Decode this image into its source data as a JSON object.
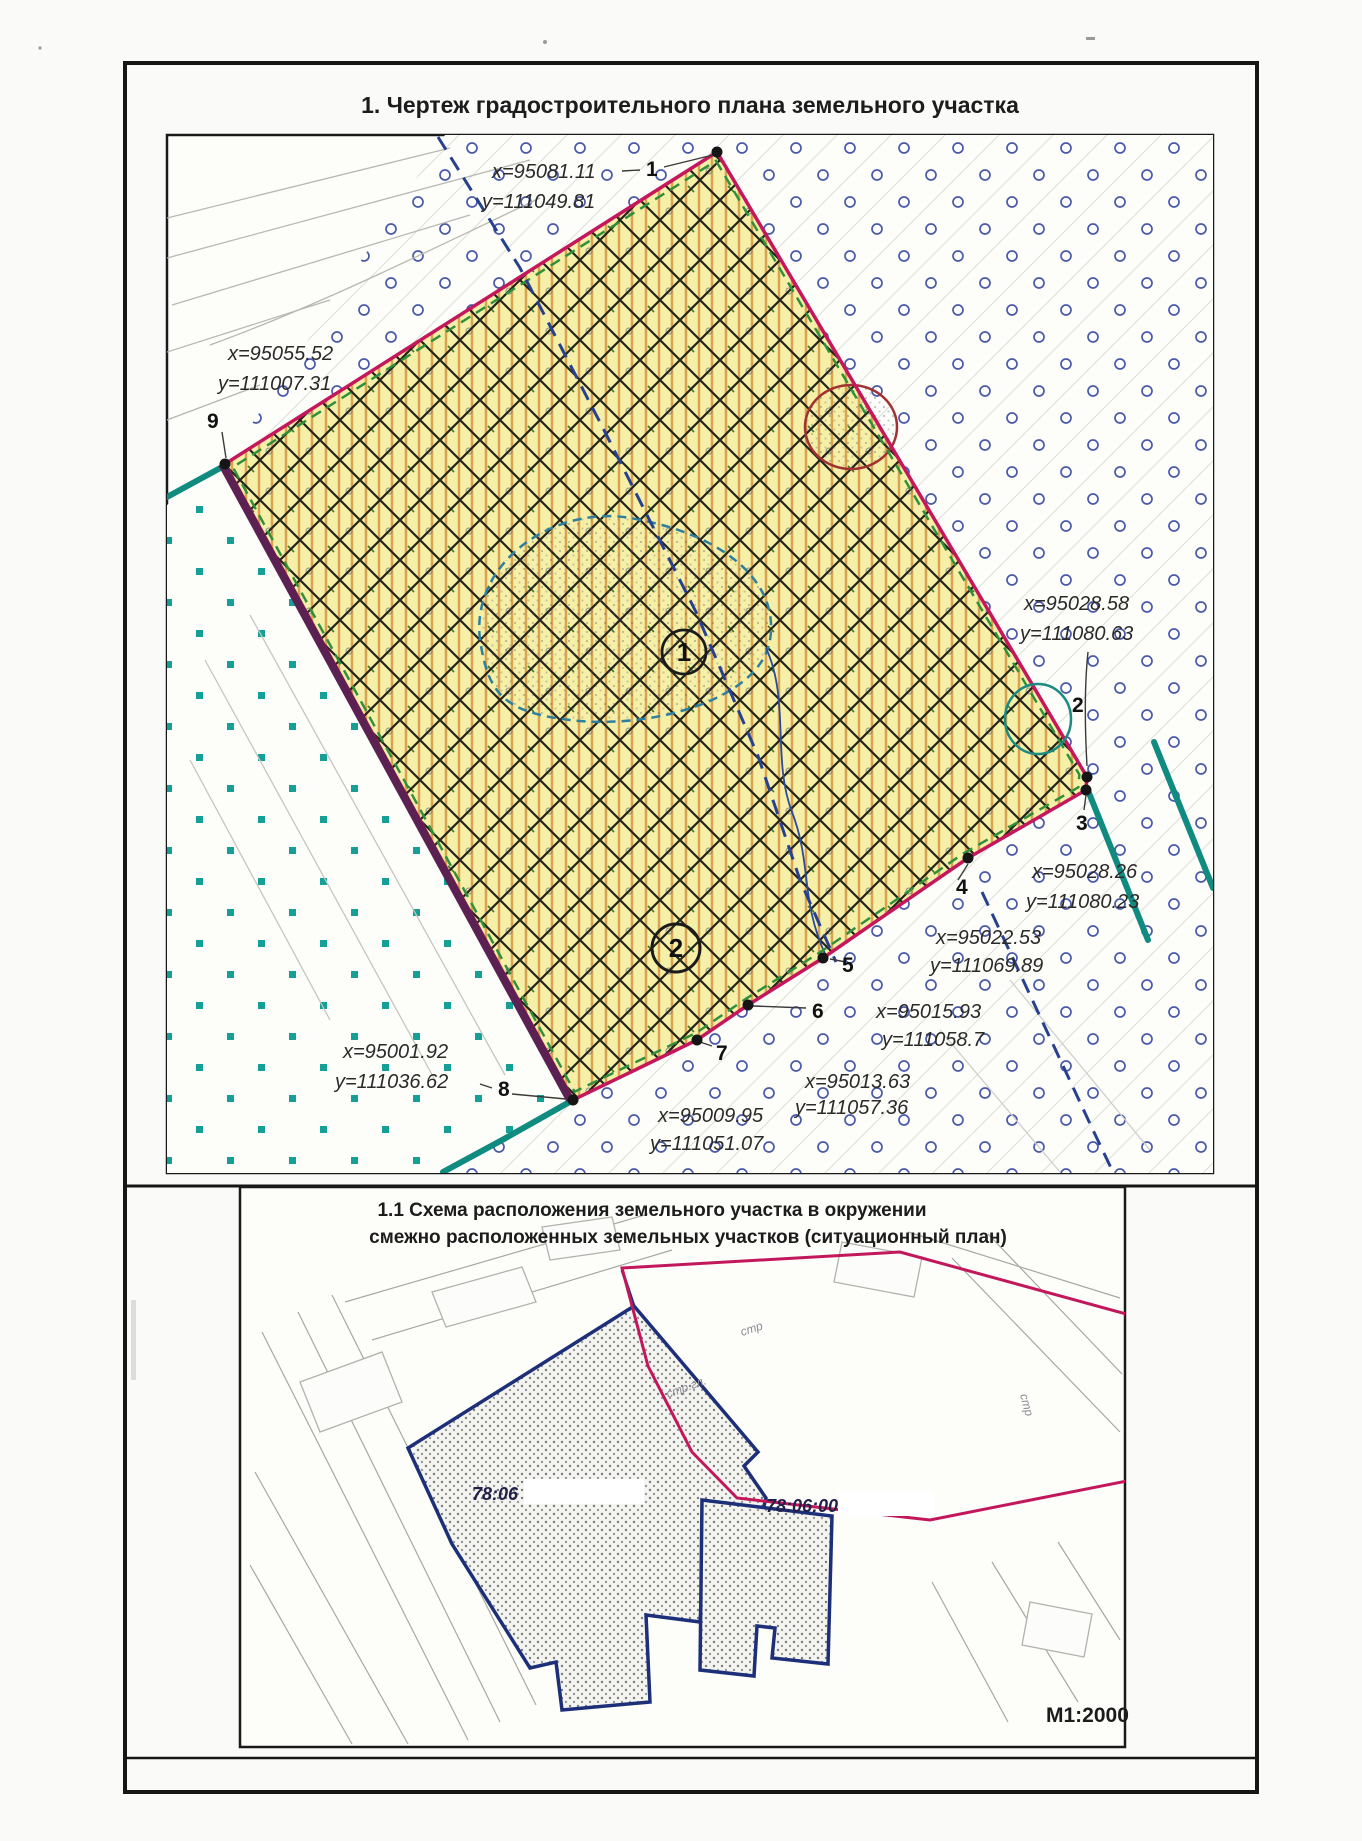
{
  "doc": {
    "main_title": "1. Чертеж градостроительного плана земельного участка",
    "situational_title_line1": "1.1 Схема расположения земельного участка  в окружении",
    "situational_title_line2": "смежно расположенных земельных участков (ситуационный план)",
    "scale_label": "М1:2000"
  },
  "main_plan": {
    "zone_labels": [
      {
        "id": "1"
      },
      {
        "id": "2"
      }
    ],
    "points": [
      {
        "n": "1",
        "x": "x=95081.11",
        "y": "y=111049.81"
      },
      {
        "n": "2",
        "x": "x=95028.58",
        "y": "y=111080.63"
      },
      {
        "n": "3",
        "x": "x=95028.26",
        "y": "y=111080.23"
      },
      {
        "n": "4",
        "x": "x=95022.53",
        "y": "y=111069.89"
      },
      {
        "n": "5",
        "x": "x=95015.93",
        "y": "y=111058.7"
      },
      {
        "n": "6",
        "x": "x=95013.63",
        "y": "y=111057.36"
      },
      {
        "n": "7",
        "x": "x=95009.95",
        "y": "y=111051.07"
      },
      {
        "n": "8",
        "x": "x=95001.92",
        "y": "y=111036.62"
      },
      {
        "n": "9",
        "x": "x=95055.52",
        "y": "y=111007.31"
      }
    ]
  },
  "situational_plan": {
    "cadastral_label_1": "78:06",
    "cadastral_label_2": "78:06:00",
    "small_labels": [
      "стр",
      "стр.гл.",
      "стр"
    ]
  },
  "colors": {
    "parcel_boundary": "#c4175c",
    "parcel_fill": "#f6efa8",
    "hatch_lines": "#23231c",
    "stripe_lines": "#d9a24f",
    "left_edge": "#5b2152",
    "green_dashed": "#2f8f3a",
    "blue_dashed": "#27418f",
    "teal_lines": "#0f8b80",
    "circle_symbols": "#4a5aa8",
    "square_symbols": "#15a097",
    "situational_red": "#c2185b",
    "situational_blue": "#1c2f78"
  }
}
